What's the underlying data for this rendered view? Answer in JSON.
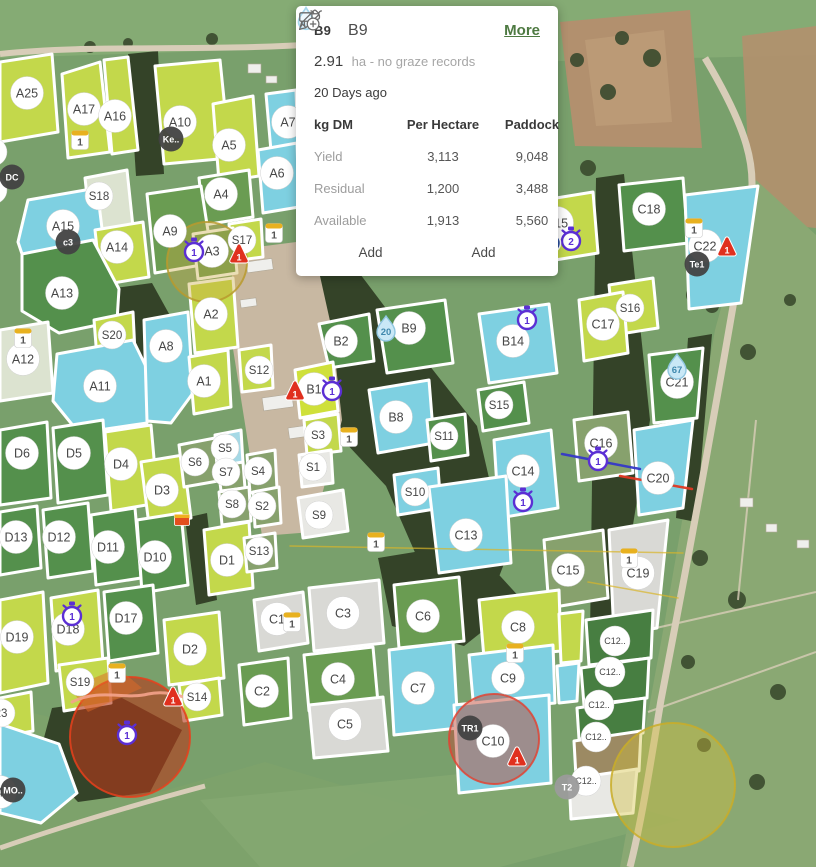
{
  "popup": {
    "chip": "B9",
    "title": "B9",
    "more_label": "More",
    "area_value": "2.91",
    "area_suffix": "ha - no graze records",
    "water_days": "20 Days ago",
    "table": {
      "col1": "kg DM",
      "col2": "Per Hectare",
      "col3": "Paddock",
      "rows": [
        {
          "label": "Yield",
          "per_hectare": "3,113",
          "paddock": "9,048"
        },
        {
          "label": "Residual",
          "per_hectare": "1,200",
          "paddock": "3,488"
        },
        {
          "label": "Available",
          "per_hectare": "1,913",
          "paddock": "5,560"
        }
      ]
    },
    "actions": [
      {
        "icon": "cow-icon",
        "label": "Add"
      },
      {
        "icon": "pencil-plus-icon",
        "label": "Add"
      }
    ]
  },
  "colors": {
    "lime": "#c3d84b",
    "lime2": "#cfe03a",
    "green": "#6a9c52",
    "dgreen": "#54904c",
    "dgreen2": "#477e41",
    "blue": "#7ed0e1",
    "pblue": "#a5d9e6",
    "gray": "#d9d9d5",
    "white": "#e8e8e4",
    "muted": "#87a16d",
    "tan": "#9c8a63",
    "pale": "#dce3d0",
    "alert_red": "#e0301e",
    "timer_purple": "#5b2fd4",
    "tag_yellow": "#e8b11f",
    "water_blue": "#c9e8f6",
    "more_green": "#4e7a42"
  },
  "map": {
    "paddocks": [
      {
        "l": "A25",
        "f": "lime",
        "x": 27,
        "y": 93,
        "s": "m",
        "p": "0,62 52,54 58,132 0,142"
      },
      {
        "l": "A17",
        "f": "lime",
        "x": 84,
        "y": 109,
        "s": "m",
        "p": "62,74 100,62 110,152 68,158"
      },
      {
        "l": "A16",
        "f": "lime",
        "x": 115,
        "y": 116,
        "s": "m",
        "p": "104,60 128,57 138,150 112,154"
      },
      {
        "l": "A10",
        "f": "lime",
        "x": 180,
        "y": 122,
        "s": "m",
        "p": "155,66 220,60 230,158 164,164"
      },
      {
        "l": "A5",
        "f": "lime",
        "x": 229,
        "y": 145,
        "s": "m",
        "p": "213,104 253,96 259,176 219,182"
      },
      {
        "l": "A7",
        "f": "blue",
        "x": 288,
        "y": 122,
        "s": "m",
        "p": "266,94 296,90 298,148 271,151"
      },
      {
        "l": "A6",
        "f": "blue",
        "x": 277,
        "y": 173,
        "s": "m",
        "p": "258,150 297,143 299,207 263,213"
      },
      {
        "l": "A4",
        "f": "green",
        "x": 221,
        "y": 194,
        "s": "m",
        "p": "199,178 249,170 253,217 204,225"
      },
      {
        "l": "A9",
        "f": "green",
        "x": 170,
        "y": 231,
        "s": "m",
        "p": "147,194 201,186 213,263 155,273"
      },
      {
        "l": "S18",
        "f": "pale",
        "x": 99,
        "y": 196,
        "s": "s",
        "p": "85,178 127,170 133,227 91,233"
      },
      {
        "l": "A15",
        "f": "blue",
        "x": 63,
        "y": 226,
        "s": "m",
        "p": "28,200 97,188 107,269 89,293 33,287 18,242"
      },
      {
        "l": "A14",
        "f": "lime",
        "x": 117,
        "y": 247,
        "s": "m",
        "p": "95,230 143,222 149,277 101,285"
      },
      {
        "l": "A13",
        "f": "dgreen",
        "x": 62,
        "y": 293,
        "s": "m",
        "p": "22,254 93,240 119,289 117,321 59,333 22,311"
      },
      {
        "l": "S17",
        "f": "lime",
        "x": 242,
        "y": 240,
        "s": "s",
        "p": "229,224 261,219 263,257 232,261"
      },
      {
        "l": "A3",
        "f": "green",
        "x": 212,
        "y": 251,
        "s": "m",
        "p": "193,234 233,228 237,273 198,279"
      },
      {
        "l": "A2",
        "f": "lime",
        "x": 211,
        "y": 314,
        "s": "m",
        "p": "189,284 233,278 238,347 195,353"
      },
      {
        "l": "S20",
        "f": "lime",
        "x": 112,
        "y": 335,
        "s": "s",
        "p": "94,320 133,312 135,353 97,358"
      },
      {
        "l": "A12",
        "f": "pale",
        "x": 23,
        "y": 359,
        "s": "m",
        "p": "0,330 48,322 53,393 0,401"
      },
      {
        "l": "A11",
        "f": "blue",
        "x": 100,
        "y": 386,
        "s": "m",
        "p": "57,354 133,340 153,381 147,423 79,433 53,401"
      },
      {
        "l": "A8",
        "f": "blue",
        "x": 166,
        "y": 346,
        "s": "m",
        "p": "144,320 188,312 193,393 171,423 147,421"
      },
      {
        "l": "A1",
        "f": "lime",
        "x": 204,
        "y": 381,
        "s": "m",
        "p": "189,357 228,350 231,407 194,414"
      },
      {
        "l": "S12",
        "f": "lime",
        "x": 259,
        "y": 370,
        "s": "s",
        "p": "239,350 271,345 273,388 242,392"
      },
      {
        "l": "B2",
        "f": "dgreen",
        "x": 341,
        "y": 341,
        "s": "m",
        "p": "319,324 369,314 374,361 329,368"
      },
      {
        "l": "B9",
        "f": "dgreen",
        "x": 409,
        "y": 328,
        "s": "m",
        "p": "377,310 445,300 453,363 387,373"
      },
      {
        "l": "B14",
        "f": "blue",
        "x": 513,
        "y": 341,
        "s": "m",
        "p": "479,314 549,304 557,373 489,383"
      },
      {
        "l": "B1",
        "f": "lime2",
        "x": 314,
        "y": 389,
        "s": "m",
        "p": "295,370 333,362 338,411 300,418"
      },
      {
        "l": "B8",
        "f": "blue",
        "x": 396,
        "y": 417,
        "s": "m",
        "p": "369,390 429,380 434,443 378,453"
      },
      {
        "l": "S3",
        "f": "lime",
        "x": 318,
        "y": 435,
        "s": "s",
        "p": "304,420 338,414 341,451 307,455"
      },
      {
        "l": "S1",
        "f": "white",
        "x": 313,
        "y": 467,
        "s": "s",
        "p": "299,455 331,450 333,483 302,487"
      },
      {
        "l": "S15",
        "f": "dgreen",
        "x": 499,
        "y": 405,
        "s": "s",
        "p": "478,390 524,382 529,423 483,431"
      },
      {
        "l": "S11",
        "f": "dgreen",
        "x": 444,
        "y": 436,
        "s": "s",
        "p": "427,420 465,414 468,455 431,461"
      },
      {
        "l": "S10",
        "f": "blue",
        "x": 415,
        "y": 492,
        "s": "s",
        "p": "394,475 438,468 441,508 398,515"
      },
      {
        "l": "C14",
        "f": "blue",
        "x": 523,
        "y": 471,
        "s": "m",
        "p": "494,440 551,430 558,508 499,518"
      },
      {
        "l": "C13",
        "f": "blue",
        "x": 466,
        "y": 535,
        "s": "m",
        "p": "429,487 506,476 511,563 439,573"
      },
      {
        "l": "S9",
        "f": "white",
        "x": 319,
        "y": 515,
        "s": "s",
        "p": "298,498 343,490 348,531 303,538"
      },
      {
        "l": "B15",
        "f": "lime",
        "x": 557,
        "y": 223,
        "s": "m",
        "p": "544,200 593,192 598,253 549,261"
      },
      {
        "l": "C18",
        "f": "dgreen",
        "x": 649,
        "y": 209,
        "s": "m",
        "p": "619,185 683,178 688,243 624,251"
      },
      {
        "l": "C22",
        "f": "blue",
        "x": 705,
        "y": 246,
        "s": "m",
        "p": "685,195 758,186 741,303 689,309"
      },
      {
        "l": "S16",
        "f": "lime",
        "x": 630,
        "y": 308,
        "s": "s",
        "p": "609,285 653,278 658,328 614,335"
      },
      {
        "l": "C17",
        "f": "lime",
        "x": 603,
        "y": 324,
        "s": "m",
        "p": "579,300 623,292 628,353 584,361"
      },
      {
        "l": "C21",
        "f": "dgreen",
        "x": 677,
        "y": 382,
        "s": "m",
        "p": "649,355 703,348 697,418 654,423"
      },
      {
        "l": "C16",
        "f": "muted",
        "x": 601,
        "y": 443,
        "s": "m",
        "p": "574,420 628,412 633,473 579,481"
      },
      {
        "l": "C20",
        "f": "blue",
        "x": 658,
        "y": 478,
        "s": "m",
        "p": "634,430 693,420 683,508 639,515"
      },
      {
        "l": "C15",
        "f": "muted",
        "x": 568,
        "y": 570,
        "s": "m",
        "p": "544,540 603,530 608,598 549,608"
      },
      {
        "l": "C19",
        "f": "gray",
        "x": 638,
        "y": 573,
        "s": "m",
        "p": "609,530 668,520 657,628 614,635"
      },
      {
        "l": "D6",
        "f": "dgreen",
        "x": 22,
        "y": 453,
        "s": "m",
        "p": "0,430 47,422 51,498 0,505"
      },
      {
        "l": "D5",
        "f": "dgreen",
        "x": 74,
        "y": 453,
        "s": "m",
        "p": "53,428 103,420 108,495 58,503"
      },
      {
        "l": "D4",
        "f": "lime",
        "x": 121,
        "y": 464,
        "s": "m",
        "p": "105,432 151,425 158,503 111,511"
      },
      {
        "l": "D3",
        "f": "lime",
        "x": 162,
        "y": 490,
        "s": "m",
        "p": "141,462 183,455 191,518 149,525"
      },
      {
        "l": "S6",
        "f": "muted",
        "x": 195,
        "y": 462,
        "s": "s",
        "p": "179,445 215,438 218,481 184,487"
      },
      {
        "l": "S5",
        "f": "pblue",
        "x": 225,
        "y": 448,
        "s": "s",
        "p": "215,435 241,430 243,463 218,467"
      },
      {
        "l": "S7",
        "f": "muted",
        "x": 226,
        "y": 472,
        "s": "s",
        "p": "218,466 243,462 245,488 221,491"
      },
      {
        "l": "S4",
        "f": "muted",
        "x": 258,
        "y": 471,
        "s": "s",
        "p": "247,455 275,450 277,489 250,493"
      },
      {
        "l": "S8",
        "f": "muted",
        "x": 232,
        "y": 504,
        "s": "s",
        "p": "219,492 249,487 251,521 222,525"
      },
      {
        "l": "S2",
        "f": "muted",
        "x": 262,
        "y": 506,
        "s": "s",
        "p": "253,492 279,487 281,523 255,527"
      },
      {
        "l": "D13",
        "f": "dgreen",
        "x": 16,
        "y": 537,
        "s": "m",
        "p": "0,512 37,506 41,568 0,575"
      },
      {
        "l": "D12",
        "f": "dgreen",
        "x": 59,
        "y": 537,
        "s": "m",
        "p": "43,510 88,503 93,571 48,578"
      },
      {
        "l": "D11",
        "f": "dgreen",
        "x": 108,
        "y": 547,
        "s": "m",
        "p": "91,515 135,508 141,578 96,585"
      },
      {
        "l": "D10",
        "f": "dgreen",
        "x": 155,
        "y": 557,
        "s": "m",
        "p": "137,520 181,513 188,585 142,593"
      },
      {
        "l": "D1",
        "f": "lime",
        "x": 227,
        "y": 560,
        "s": "m",
        "p": "204,530 249,522 253,588 209,595"
      },
      {
        "l": "S13",
        "f": "muted",
        "x": 259,
        "y": 551,
        "s": "s",
        "p": "244,538 275,533 277,568 247,572"
      },
      {
        "l": "D19",
        "f": "lime",
        "x": 17,
        "y": 637,
        "s": "m",
        "p": "0,600 43,592 48,683 0,693"
      },
      {
        "l": "D18",
        "f": "lime",
        "x": 68,
        "y": 629,
        "s": "m",
        "p": "51,598 98,590 103,663 56,671"
      },
      {
        "l": "D17",
        "f": "dgreen",
        "x": 126,
        "y": 618,
        "s": "m",
        "p": "104,592 153,585 158,653 109,661"
      },
      {
        "l": "D2",
        "f": "lime",
        "x": 190,
        "y": 649,
        "s": "m",
        "p": "164,620 219,612 224,678 169,685"
      },
      {
        "l": "S19",
        "f": "lime",
        "x": 80,
        "y": 682,
        "s": "s",
        "p": "59,665 108,658 111,703 64,711"
      },
      {
        "l": "S14",
        "f": "lime",
        "x": 197,
        "y": 697,
        "s": "s",
        "p": "179,685 219,678 222,715 184,721"
      },
      {
        "l": "23",
        "f": "lime",
        "x": 1,
        "y": 713,
        "s": "s",
        "p": "0,698 31,692 33,731 0,737"
      },
      {
        "l": "4",
        "f": "blue",
        "x": 0,
        "y": 792,
        "s": "m",
        "p": "0,724 59,744 77,793 41,823 0,813"
      },
      {
        "l": "",
        "x": -7,
        "y": 152,
        "s": "s"
      },
      {
        "l": "",
        "x": -7,
        "y": 190,
        "s": "s"
      },
      {
        "l": "C1",
        "f": "gray",
        "x": 277,
        "y": 619,
        "s": "m",
        "p": "254,600 303,592 308,643 259,651"
      },
      {
        "l": "C3",
        "f": "gray",
        "x": 343,
        "y": 613,
        "s": "m",
        "p": "309,588 379,580 384,643 314,651"
      },
      {
        "l": "C6",
        "f": "green",
        "x": 423,
        "y": 616,
        "s": "m",
        "p": "394,585 459,577 464,641 399,648"
      },
      {
        "l": "C8",
        "f": "lime",
        "x": 518,
        "y": 627,
        "s": "m",
        "p": "479,600 559,590 561,651 484,658"
      },
      {
        "l": "C2",
        "f": "green",
        "x": 262,
        "y": 691,
        "s": "m",
        "p": "239,665 288,658 291,718 244,725"
      },
      {
        "l": "C4",
        "f": "green",
        "x": 338,
        "y": 679,
        "s": "m",
        "p": "304,655 373,647 378,703 309,711"
      },
      {
        "l": "C5",
        "f": "gray",
        "x": 345,
        "y": 724,
        "s": "m",
        "p": "309,705 383,697 388,751 314,758"
      },
      {
        "l": "C7",
        "f": "blue",
        "x": 418,
        "y": 688,
        "s": "m",
        "p": "389,650 453,642 458,728 394,735"
      },
      {
        "l": "C9",
        "f": "blue",
        "x": 508,
        "y": 678,
        "s": "m",
        "p": "469,655 553,645 555,703 474,711"
      },
      {
        "l": "C10",
        "f": "blue",
        "x": 493,
        "y": 741,
        "s": "m",
        "p": "454,705 549,695 551,783 459,793"
      },
      {
        "l": "",
        "f": "lime",
        "p": "559,614 583,611 581,661 561,663"
      },
      {
        "l": "",
        "f": "blue",
        "p": "557,666 579,663 577,701 559,703"
      },
      {
        "l": "C12..",
        "f": "dgreen2",
        "x": 615,
        "y": 641,
        "s": "xs",
        "p": "586,620 653,610 651,658 589,665"
      },
      {
        "l": "C12..",
        "f": "dgreen2",
        "x": 610,
        "y": 672,
        "s": "xs",
        "p": "581,668 649,658 647,698 584,705"
      },
      {
        "l": "C12..",
        "f": "dgreen2",
        "x": 599,
        "y": 705,
        "s": "xs",
        "p": "577,708 645,698 643,733 579,739"
      },
      {
        "l": "C12..",
        "f": "tan",
        "x": 596,
        "y": 737,
        "s": "xs",
        "p": "574,741 641,731 639,771 576,777"
      },
      {
        "l": "C12..",
        "f": "white",
        "x": 586,
        "y": 781,
        "s": "xs",
        "p": "569,779 637,769 633,813 571,819"
      }
    ],
    "badges": [
      {
        "t": "tag",
        "v": "1",
        "x": 80,
        "y": 140
      },
      {
        "t": "tag",
        "v": "1",
        "x": 274,
        "y": 233
      },
      {
        "t": "tag",
        "v": "1",
        "x": 23,
        "y": 338
      },
      {
        "t": "tag",
        "v": "1",
        "x": 349,
        "y": 437
      },
      {
        "t": "tag",
        "v": "1",
        "x": 376,
        "y": 542
      },
      {
        "t": "tag",
        "v": "1",
        "x": 694,
        "y": 228
      },
      {
        "t": "tag",
        "v": "1",
        "x": 629,
        "y": 558
      },
      {
        "t": "tag",
        "v": "1",
        "x": 292,
        "y": 622
      },
      {
        "t": "tag",
        "v": "1",
        "x": 515,
        "y": 653
      },
      {
        "t": "tag",
        "v": "1",
        "x": 117,
        "y": 673
      },
      {
        "t": "alert",
        "v": "1",
        "x": 295,
        "y": 391
      },
      {
        "t": "alert",
        "v": "1",
        "x": 727,
        "y": 247
      },
      {
        "t": "alert",
        "v": "1",
        "x": 517,
        "y": 757
      },
      {
        "t": "alert",
        "v": "1",
        "x": 173,
        "y": 697
      },
      {
        "t": "alert",
        "v": "1",
        "x": 239,
        "y": 254
      },
      {
        "t": "timer",
        "v": "1",
        "x": 194,
        "y": 252
      },
      {
        "t": "timer",
        "v": "1",
        "x": 332,
        "y": 391
      },
      {
        "t": "timer",
        "v": "1",
        "x": 527,
        "y": 320
      },
      {
        "t": "timer",
        "v": "2",
        "x": 571,
        "y": 241
      },
      {
        "t": "timer",
        "v": "1",
        "x": 598,
        "y": 461
      },
      {
        "t": "timer",
        "v": "1",
        "x": 523,
        "y": 502
      },
      {
        "t": "timer",
        "v": "1",
        "x": 72,
        "y": 616
      },
      {
        "t": "timer",
        "v": "1",
        "x": 127,
        "y": 735
      },
      {
        "t": "water",
        "v": "20",
        "x": 386,
        "y": 328
      },
      {
        "t": "water",
        "v": "67",
        "x": 677,
        "y": 366
      },
      {
        "t": "dark",
        "v": "Ke..",
        "x": 171,
        "y": 139
      },
      {
        "t": "dark",
        "v": "c3",
        "x": 68,
        "y": 242
      },
      {
        "t": "dark",
        "v": "DC",
        "x": 12,
        "y": 177
      },
      {
        "t": "dark",
        "v": "Te1",
        "x": 697,
        "y": 264
      },
      {
        "t": "dark",
        "v": "TR1",
        "x": 470,
        "y": 728
      },
      {
        "t": "dark",
        "v": "MO..",
        "x": 13,
        "y": 790
      },
      {
        "t": "dark",
        "v": "T2",
        "x": 567,
        "y": 787,
        "c": "gray"
      },
      {
        "t": "dot",
        "v": "",
        "x": 551,
        "y": 243
      },
      {
        "t": "marker",
        "v": "",
        "x": 182,
        "y": 520
      }
    ],
    "highlights": [
      {
        "t": "circle",
        "x": 207,
        "y": 262,
        "r": 40,
        "f": "#c9a93e",
        "o": 0.38,
        "s": "#b89a2e"
      },
      {
        "t": "circle",
        "x": 130,
        "y": 737,
        "r": 60,
        "f": "#b5381a",
        "o": 0.62,
        "s": "#e8401c"
      },
      {
        "t": "poly",
        "p": "70,688 118,668 142,688 88,712",
        "f": "#e06a28",
        "o": 0.5
      },
      {
        "t": "path",
        "d": "M72,702 C100,688 125,700 148,694 C166,690 181,696 192,700",
        "s": "#f4a38c",
        "w": 3,
        "o": 0.9
      },
      {
        "t": "circle",
        "x": 494,
        "y": 739,
        "r": 45,
        "f": "#c04432",
        "o": 0.48,
        "s": "#e04434"
      },
      {
        "t": "circle",
        "x": 673,
        "y": 785,
        "r": 62,
        "f": "#d3bd3a",
        "o": 0.4,
        "s": "#c9ad28"
      }
    ],
    "lines": [
      {
        "x1": 562,
        "y1": 454,
        "x2": 640,
        "y2": 469,
        "s": "#3538c8",
        "w": 2.5,
        "o": 0.95
      },
      {
        "x1": 620,
        "y1": 476,
        "x2": 692,
        "y2": 489,
        "s": "#e03822",
        "w": 2.5,
        "o": 0.95
      },
      {
        "x1": 290,
        "y1": 546,
        "x2": 683,
        "y2": 553,
        "s": "#d8b52a",
        "w": 1.5,
        "o": 0.7
      },
      {
        "x1": 588,
        "y1": 582,
        "x2": 678,
        "y2": 598,
        "s": "#d8b52a",
        "w": 1.5,
        "o": 0.7
      }
    ]
  }
}
